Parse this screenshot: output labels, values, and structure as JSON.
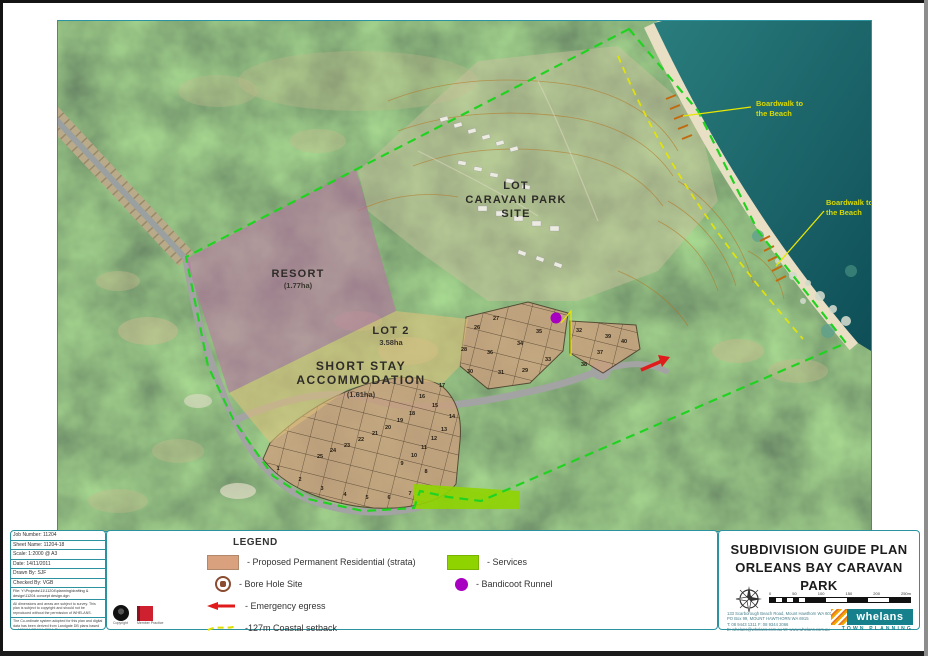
{
  "map": {
    "labels": {
      "caravan_park": [
        "LOT",
        "CARAVAN PARK",
        "SITE"
      ],
      "resort": [
        "RESORT",
        "(1.77ha)"
      ],
      "lot2": [
        "LOT 2",
        "3.58ha"
      ],
      "short_stay": [
        "SHORT STAY",
        "ACCOMMODATION",
        "(1.61ha)"
      ],
      "boardwalk_north": [
        "Boardwalk to",
        "the Beach"
      ],
      "boardwalk_south": [
        "Boardwalk to",
        "the Beach"
      ]
    },
    "lots_lower": [
      {
        "n": "1",
        "x": 220,
        "y": 449
      },
      {
        "n": "2",
        "x": 242,
        "y": 460
      },
      {
        "n": "3",
        "x": 264,
        "y": 469
      },
      {
        "n": "4",
        "x": 287,
        "y": 475
      },
      {
        "n": "5",
        "x": 309,
        "y": 478
      },
      {
        "n": "6",
        "x": 331,
        "y": 478
      },
      {
        "n": "7",
        "x": 352,
        "y": 474
      },
      {
        "n": "8",
        "x": 368,
        "y": 452
      },
      {
        "n": "9",
        "x": 344,
        "y": 444
      },
      {
        "n": "10",
        "x": 356,
        "y": 436
      },
      {
        "n": "11",
        "x": 366,
        "y": 428
      },
      {
        "n": "12",
        "x": 376,
        "y": 419
      },
      {
        "n": "13",
        "x": 386,
        "y": 410
      },
      {
        "n": "14",
        "x": 394,
        "y": 397
      },
      {
        "n": "15",
        "x": 377,
        "y": 386
      },
      {
        "n": "16",
        "x": 364,
        "y": 377
      },
      {
        "n": "17",
        "x": 384,
        "y": 366
      },
      {
        "n": "18",
        "x": 354,
        "y": 394
      },
      {
        "n": "19",
        "x": 342,
        "y": 401
      },
      {
        "n": "20",
        "x": 330,
        "y": 408
      },
      {
        "n": "21",
        "x": 317,
        "y": 414
      },
      {
        "n": "22",
        "x": 303,
        "y": 420
      },
      {
        "n": "23",
        "x": 289,
        "y": 426
      },
      {
        "n": "24",
        "x": 275,
        "y": 431
      },
      {
        "n": "25",
        "x": 262,
        "y": 437
      }
    ],
    "lots_upper": [
      {
        "n": "26",
        "x": 419,
        "y": 308
      },
      {
        "n": "27",
        "x": 438,
        "y": 299
      },
      {
        "n": "28",
        "x": 406,
        "y": 330
      },
      {
        "n": "29",
        "x": 467,
        "y": 351
      },
      {
        "n": "30",
        "x": 412,
        "y": 352
      },
      {
        "n": "31",
        "x": 443,
        "y": 353
      },
      {
        "n": "32",
        "x": 521,
        "y": 311
      },
      {
        "n": "33",
        "x": 490,
        "y": 340
      },
      {
        "n": "34",
        "x": 462,
        "y": 324
      },
      {
        "n": "35",
        "x": 481,
        "y": 312
      },
      {
        "n": "36",
        "x": 432,
        "y": 333
      },
      {
        "n": "37",
        "x": 542,
        "y": 333
      },
      {
        "n": "38",
        "x": 526,
        "y": 345
      },
      {
        "n": "39",
        "x": 550,
        "y": 317
      },
      {
        "n": "40",
        "x": 566,
        "y": 322
      }
    ],
    "colors": {
      "boundary": "#21d321",
      "services": "#8fd400",
      "residential": "#c8a07e",
      "resort_overlay": "#bd6fa8",
      "short_stay_overlay": "#dcbf7c",
      "coastal_setback": "#e6e600",
      "bandicoot": "#a800c0",
      "emergency": "#e01b1b"
    }
  },
  "legend": {
    "heading": "LEGEND",
    "items": [
      {
        "icon": "residential-swatch",
        "label": "- Proposed Permanent Residential (strata)"
      },
      {
        "icon": "bore-hole-icon",
        "label": "- Bore Hole Site"
      },
      {
        "icon": "emergency-egress-arrow-icon",
        "label": "- Emergency egress"
      },
      {
        "icon": "coastal-setback-line-icon",
        "label": "-127m Coastal setback"
      },
      {
        "icon": "services-swatch",
        "label": "- Services"
      },
      {
        "icon": "bandicoot-runnel-icon",
        "label": "- Bandicoot Runnel"
      }
    ]
  },
  "infobox": {
    "rows": [
      "Job Number: 11204",
      "Sheet Name: 11204-18",
      "Scale: 1:2000 @ A3",
      "Date: 14/11/2011",
      "Drawn By: SJF",
      "Checked By: VGB"
    ],
    "file": "File: Y:\\Projects\\11\\11204\\planning\\drafting & design\\11204 concept design.dgn",
    "notes": [
      "All dimensions and areas are subject to survey. This plan is subject to copyright and should not be reproduced without the permission of WHELANS.",
      "The Co-ordinate system adopted for this plan and digital data has been derived from Landgate DB plans based on MGA94 GDA94, 2094. This statement must accompany this plan and digital data at all times."
    ],
    "logo_captions": [
      "Copyright",
      "Member Practice"
    ]
  },
  "titleblock": {
    "title1": "SUBDIVISION GUIDE PLAN",
    "title2": "ORLEANS BAY CARAVAN PARK",
    "scalebar_ticks": [
      "0",
      "50",
      "100",
      "150",
      "200",
      "250m"
    ],
    "address_lines": [
      "133 Scarborough Beach Road, Mount Hawthorn WA 6016",
      "PO Box 99, MOUNT HAWTHORN WA 6915",
      "T: 08 9443 1311   F: 08 9344 2066",
      "E: whelans@whelans.com.au   W: www.whelans.com.au"
    ],
    "brand": "whelans",
    "tagline": "TOWN PLANNING"
  }
}
